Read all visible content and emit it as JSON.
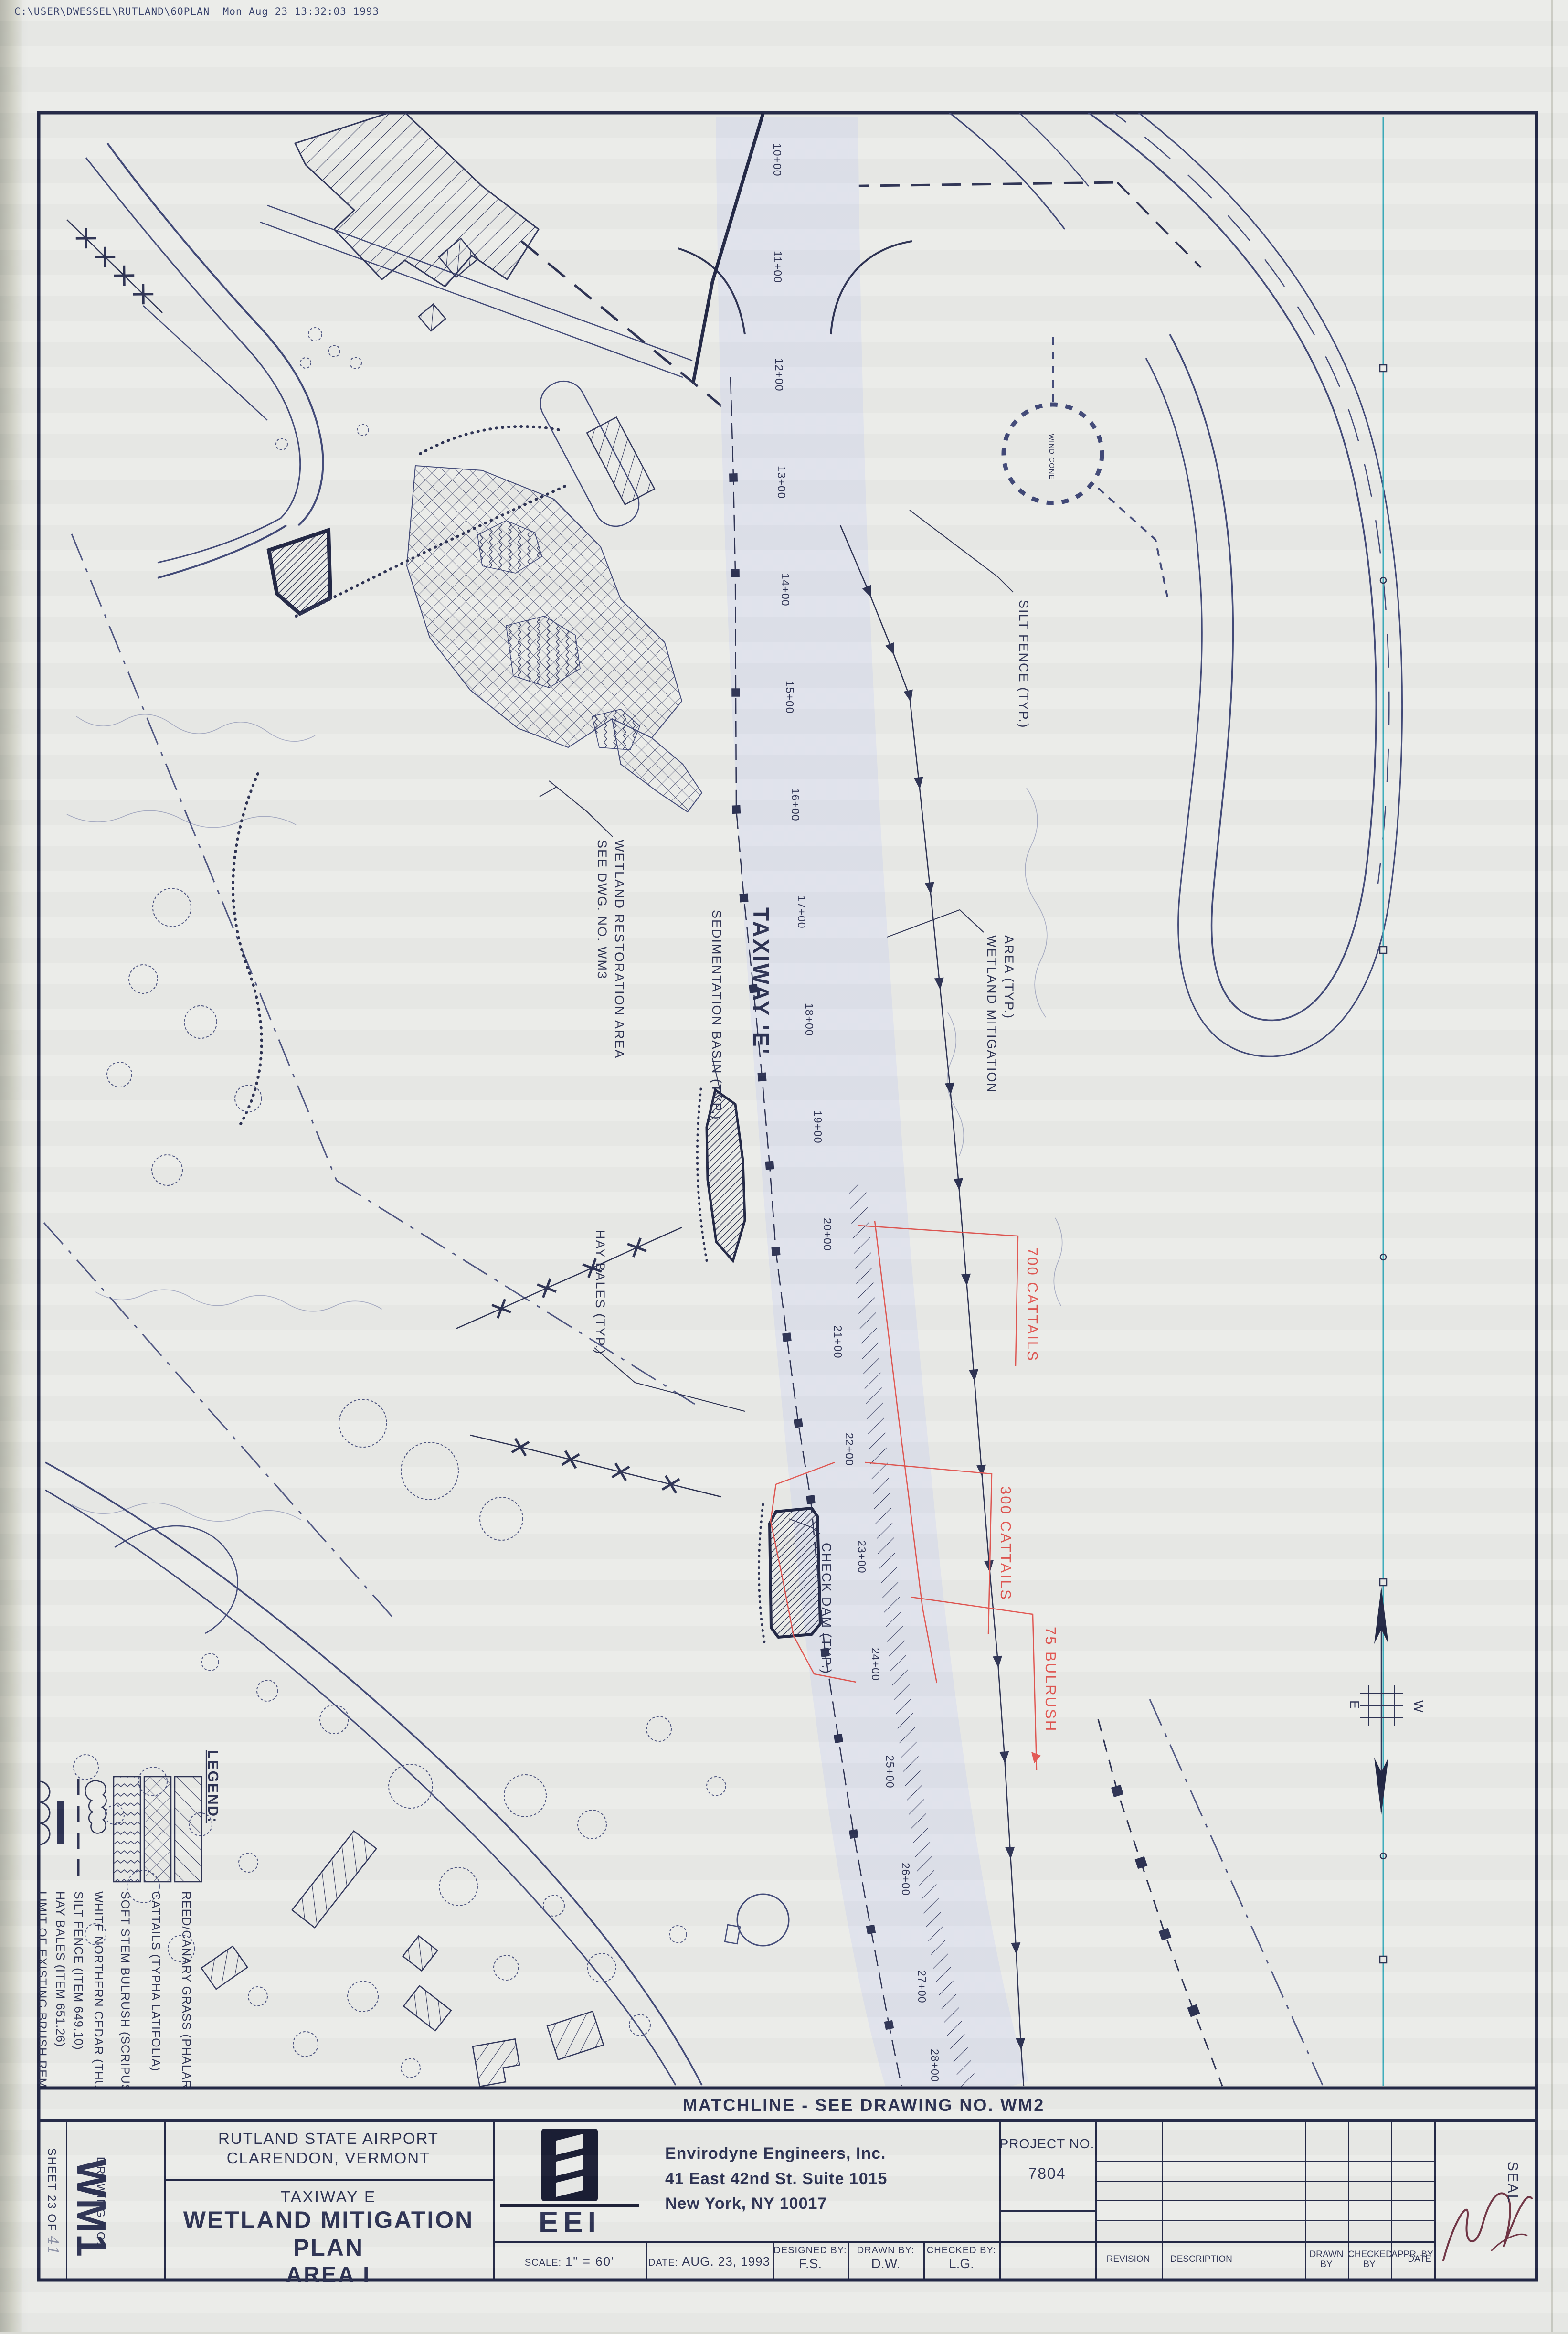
{
  "header": {
    "file_path": "C:\\USER\\DWESSEL\\RUTLAND\\60PLAN  Mon Aug 23 13:32:03 1993"
  },
  "plan": {
    "labels": {
      "silt_fence": "SILT FENCE (TYP.)",
      "taxiway": "TAXIWAY 'E'",
      "wetland_mitigation_1": "WETLAND MITIGATION",
      "wetland_mitigation_2": "AREA (TYP.)",
      "wetland_restoration_1": "WETLAND RESTORATION AREA",
      "wetland_restoration_2": "SEE DWG. NO. WM3",
      "sedimentation_basin": "SEDIMENTATION BASIN (TYP.)",
      "hay_bales": "HAY BALES (TYP.)",
      "check_dam": "CHECK DAM (TYP.)",
      "wind_cone": "WIND CONE",
      "matchline": "MATCHLINE - SEE DRAWING NO. WM2",
      "compass_e": "E",
      "compass_w": "W"
    },
    "red_annotations": [
      "700 CATTAILS",
      "300 CATTAILS",
      "75 BULRUSH"
    ],
    "stations": [
      {
        "label": "10+00"
      },
      {
        "label": "11+00"
      },
      {
        "label": "12+00"
      },
      {
        "label": "13+00"
      },
      {
        "label": "14+00"
      },
      {
        "label": "15+00"
      },
      {
        "label": "16+00"
      },
      {
        "label": "17+00"
      },
      {
        "label": "18+00"
      },
      {
        "label": "19+00"
      },
      {
        "label": "20+00"
      },
      {
        "label": "21+00"
      },
      {
        "label": "22+00"
      },
      {
        "label": "23+00"
      },
      {
        "label": "24+00"
      },
      {
        "label": "25+00"
      },
      {
        "label": "26+00"
      },
      {
        "label": "27+00"
      },
      {
        "label": "28+00"
      }
    ]
  },
  "legend": {
    "title": "LEGEND:",
    "items": [
      {
        "symbol": "diagonal-hatch",
        "label": "REED/CANARY GRASS (PHALARIS ARUNDINACEA)"
      },
      {
        "symbol": "cross-hatch",
        "label": "CATTAILS (TYPHA LATIFOLIA)"
      },
      {
        "symbol": "zigzag-hatch",
        "label": "SOFT STEM BULRUSH (SCRIPUS VALIDUS)"
      },
      {
        "symbol": "cloud-line",
        "label": "WHITE NORTHERN CEDAR (THUJA OCCIDENTALIS)"
      },
      {
        "symbol": "dashed-line",
        "label": "SILT FENCE (ITEM 649.10)"
      },
      {
        "symbol": "thick-dash",
        "label": "HAY BALES (ITEM 651.26)"
      },
      {
        "symbol": "arc-line",
        "label": "LIMIT OF EXISTING BRUSH REMOVAL"
      }
    ]
  },
  "titleblock": {
    "sheet_label": "SHEET 23 OF",
    "sheet_number": "41",
    "drawing_no_label": "DRAWING NO.",
    "drawing_no": "WM1",
    "airport": "RUTLAND STATE AIRPORT",
    "city": "CLARENDON, VERMONT",
    "taxiway": "TAXIWAY E",
    "title": "WETLAND MITIGATION PLAN",
    "area": "AREA I",
    "logo_text": "EEI",
    "firm": "Envirodyne Engineers, Inc.",
    "address1": "41 East 42nd St.  Suite 1015",
    "address2": "New York, NY  10017",
    "project_label": "PROJECT NO.",
    "project_no": "7804",
    "scale_label": "SCALE:",
    "scale_value": "1\" = 60'",
    "date_label": "DATE:",
    "date_value": "AUG. 23, 1993",
    "designed_label": "DESIGNED BY:",
    "designed_value": "F.S.",
    "drawn_label": "DRAWN BY:",
    "drawn_value": "D.W.",
    "checked_label": "CHECKED BY:",
    "checked_value": "L.G.",
    "rev_revision": "REVISION",
    "rev_description": "DESCRIPTION",
    "rev_drawn": "DRAWN BY",
    "rev_checked": "CHECKED BY",
    "rev_appr": "APPR. BY",
    "rev_date": "DATE",
    "seal": "SEAL"
  },
  "colors": {
    "ink": "#272c4e",
    "red": "#e0514c",
    "teal": "#35a9b8",
    "paper": "#eaebe8"
  }
}
